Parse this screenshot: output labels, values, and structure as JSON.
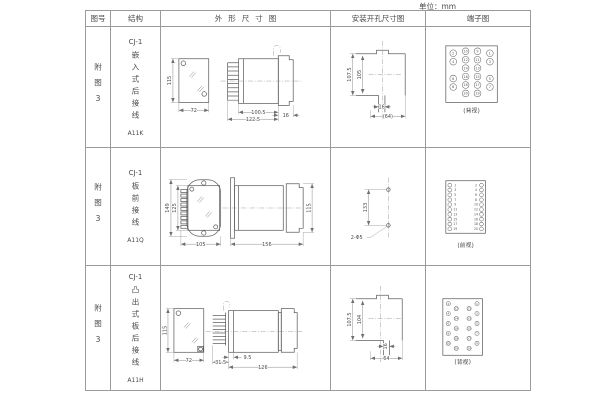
{
  "unit_label": "单位：mm",
  "table": {
    "headers": [
      "图号",
      "结构",
      "外形尺寸图",
      "安装开孔尺寸图",
      "端子图"
    ],
    "rows": [
      {
        "fig_no": "附图3",
        "series": "CJ-1",
        "structure": "嵌入式后接线",
        "code": "A11K",
        "outline": {
          "height": "115",
          "width": "72",
          "depth_body": "100.5",
          "depth_overall": "122.5",
          "flange": "16"
        },
        "install": {
          "outer_height": "107.5",
          "inner_height": "105",
          "slot_width": "16",
          "overall_width": "(64)"
        },
        "terminal": {
          "caption": "(背视)",
          "r": 3.4,
          "fs": 3.4,
          "circles": [
            {
              "x": 40,
              "y": 24.5,
              "n": "10"
            },
            {
              "x": 52,
              "y": 24.5,
              "n": "9"
            },
            {
              "x": 40,
              "y": 33,
              "n": "12"
            },
            {
              "x": 52,
              "y": 33,
              "n": "11"
            },
            {
              "x": 40,
              "y": 41.5,
              "n": "14"
            },
            {
              "x": 52,
              "y": 41.5,
              "n": "13"
            },
            {
              "x": 40,
              "y": 50,
              "n": "16"
            },
            {
              "x": 52,
              "y": 50,
              "n": "15"
            },
            {
              "x": 40,
              "y": 58.5,
              "n": "18"
            },
            {
              "x": 52,
              "y": 58.5,
              "n": "17"
            },
            {
              "x": 40,
              "y": 67,
              "n": "20"
            },
            {
              "x": 52,
              "y": 67,
              "n": "19"
            },
            {
              "x": 27.5,
              "y": 26.5,
              "n": "2"
            },
            {
              "x": 64.5,
              "y": 26.5,
              "n": "1"
            },
            {
              "x": 27.5,
              "y": 35,
              "n": "4"
            },
            {
              "x": 64.5,
              "y": 35,
              "n": "3"
            },
            {
              "x": 27.5,
              "y": 52,
              "n": "6"
            },
            {
              "x": 64.5,
              "y": 52,
              "n": "5"
            },
            {
              "x": 27.5,
              "y": 60.5,
              "n": "8"
            },
            {
              "x": 64.5,
              "y": 60.5,
              "n": "7"
            }
          ]
        }
      },
      {
        "fig_no": "附图3",
        "series": "CJ-1",
        "structure": "板前接线",
        "code": "A11Q",
        "outline": {
          "height": "149",
          "body_height": "125",
          "width": "105",
          "depth": "156",
          "end_height": "115"
        },
        "install": {
          "hole_spacing": "133",
          "holes": "2-Φ5"
        },
        "terminal": {
          "caption": "(前视)",
          "r": 1.9,
          "fs": 3.2,
          "circles": [
            {
              "x": 24,
              "tx": 29.5,
              "y": 37.5,
              "n": "1"
            },
            {
              "x": 56,
              "tx": 50.5,
              "y": 37.5,
              "n": "2"
            },
            {
              "x": 24,
              "tx": 29.5,
              "y": 42.4,
              "n": "3"
            },
            {
              "x": 56,
              "tx": 50.5,
              "y": 42.4,
              "n": "4"
            },
            {
              "x": 24,
              "tx": 29.5,
              "y": 47.3,
              "n": "5"
            },
            {
              "x": 56,
              "tx": 50.5,
              "y": 47.3,
              "n": "6"
            },
            {
              "x": 24,
              "tx": 29.5,
              "y": 52.2,
              "n": "7"
            },
            {
              "x": 56,
              "tx": 50.5,
              "y": 52.2,
              "n": "8"
            },
            {
              "x": 24,
              "tx": 29.5,
              "y": 57.1,
              "n": "9"
            },
            {
              "x": 56,
              "tx": 50.5,
              "y": 57.1,
              "n": "10"
            },
            {
              "x": 24,
              "tx": 29.5,
              "y": 62,
              "n": "11"
            },
            {
              "x": 56,
              "tx": 50.5,
              "y": 62,
              "n": "12"
            },
            {
              "x": 24,
              "tx": 29.5,
              "y": 66.9,
              "n": "13"
            },
            {
              "x": 56,
              "tx": 50.5,
              "y": 66.9,
              "n": "14"
            },
            {
              "x": 24,
              "tx": 29.5,
              "y": 71.8,
              "n": "15"
            },
            {
              "x": 56,
              "tx": 50.5,
              "y": 71.8,
              "n": "16"
            },
            {
              "x": 24,
              "tx": 29.5,
              "y": 76.7,
              "n": "17"
            },
            {
              "x": 56,
              "tx": 50.5,
              "y": 76.7,
              "n": "18"
            },
            {
              "x": 24,
              "tx": 29.5,
              "y": 81.6,
              "n": "19"
            },
            {
              "x": 56,
              "tx": 50.5,
              "y": 81.6,
              "n": "20"
            }
          ]
        }
      },
      {
        "fig_no": "附图3",
        "series": "CJ-1",
        "structure": "凸出式板后接线",
        "code": "A11H",
        "outline": {
          "height": "115",
          "width": "72",
          "pin_depth": "31.5",
          "step": "9.5",
          "depth": "126"
        },
        "install": {
          "outer_height": "107.5",
          "inner_height": "104",
          "slot_width": "16",
          "overall_width": "64"
        },
        "terminal": {
          "caption": "(背视)",
          "r": 2.1,
          "fs": 3,
          "circles": [
            {
              "x": 22.5,
              "y": 38,
              "n": "2"
            },
            {
              "x": 51.5,
              "y": 38,
              "n": "1"
            },
            {
              "x": 30.5,
              "y": 43,
              "n": "12"
            },
            {
              "x": 43.5,
              "y": 43,
              "n": "11"
            },
            {
              "x": 22.5,
              "y": 48,
              "n": "4"
            },
            {
              "x": 51.5,
              "y": 48,
              "n": "3"
            },
            {
              "x": 30.5,
              "y": 53,
              "n": "14"
            },
            {
              "x": 43.5,
              "y": 53,
              "n": "13"
            },
            {
              "x": 22.5,
              "y": 58,
              "n": "6"
            },
            {
              "x": 51.5,
              "y": 58,
              "n": "5"
            },
            {
              "x": 30.5,
              "y": 63,
              "n": "16"
            },
            {
              "x": 43.5,
              "y": 63,
              "n": "15"
            },
            {
              "x": 22.5,
              "y": 68,
              "n": "8"
            },
            {
              "x": 51.5,
              "y": 68,
              "n": "7"
            },
            {
              "x": 30.5,
              "y": 73,
              "n": "18"
            },
            {
              "x": 43.5,
              "y": 73,
              "n": "17"
            },
            {
              "x": 22.5,
              "y": 78,
              "n": "10"
            },
            {
              "x": 51.5,
              "y": 78,
              "n": "9"
            },
            {
              "x": 30.5,
              "y": 83,
              "n": "20"
            },
            {
              "x": 43.5,
              "y": 83,
              "n": "19"
            }
          ]
        }
      }
    ]
  }
}
